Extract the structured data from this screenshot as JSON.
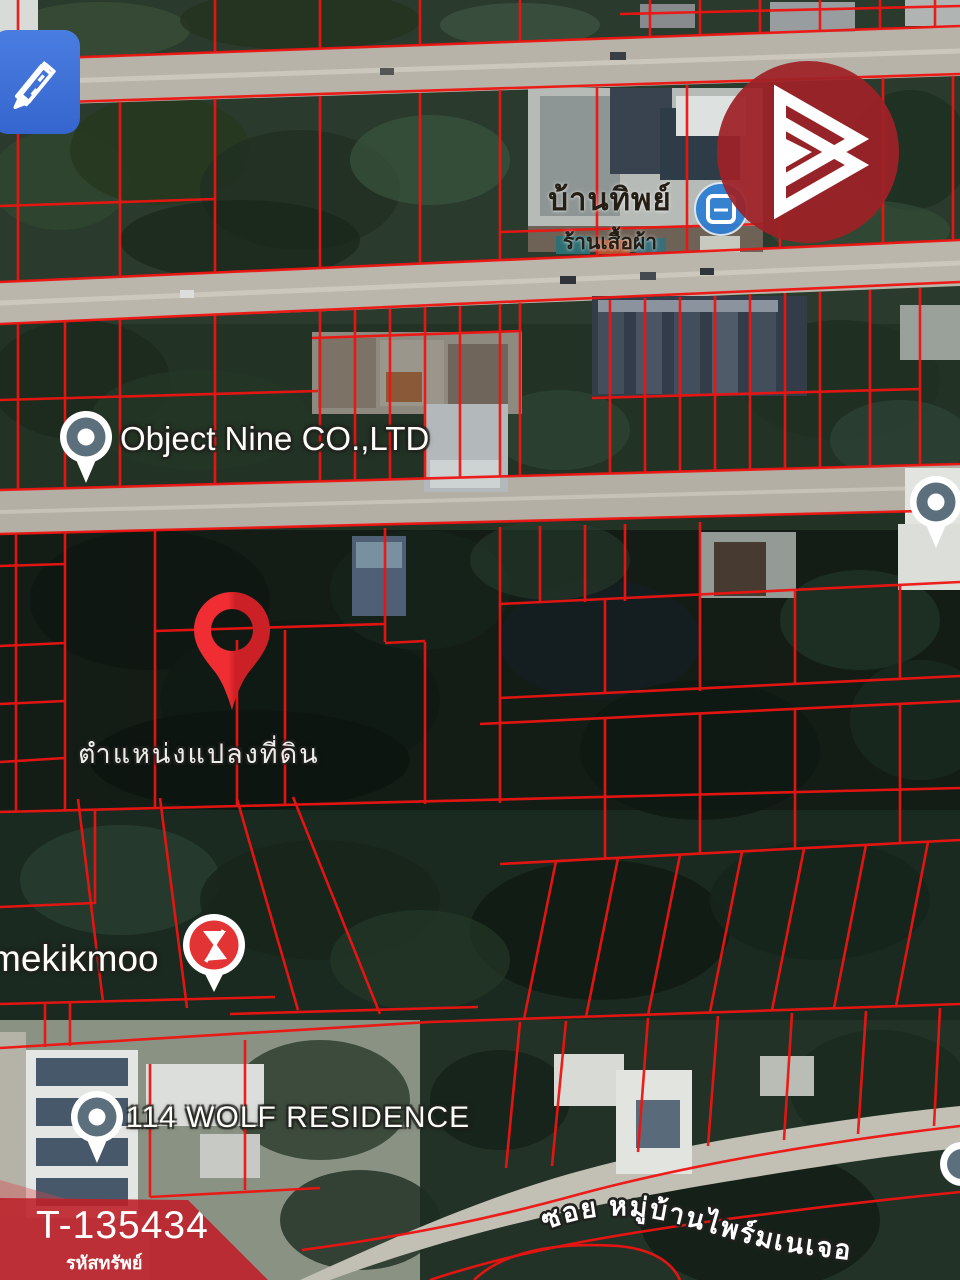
{
  "labels": {
    "shop": {
      "name": "บ้านทิพย์",
      "subtitle": "ร้านเสื้อผ้า"
    },
    "company": "Object Nine CO.,LTD",
    "plot_caption": "ตำแหน่งแปลงที่ดิน",
    "mekikmoo": "mekikmoo",
    "residence": "114 WOLF RESIDENCE",
    "road": "ซอย หมู่บ้านไพร์มเนเจอ"
  },
  "badge": {
    "code": "T-135434",
    "label": "รหัสทรัพย์"
  },
  "icons": {
    "edit_button": "pencil-ruler-icon",
    "brand_logo": "triangle-b-logo",
    "location_pin": "red-location-pin",
    "company_pin": "grey-poi-pin",
    "residence_pin": "grey-poi-pin",
    "right_edge_pin": "grey-poi-pin",
    "mekikmoo_pin": "red-poi-pin",
    "store": "storefront-icon"
  },
  "colors": {
    "parcel_line": "#ee1411",
    "badge_red": "#be212a",
    "brand_red": "#9e2127",
    "pin_red": "#e8252b",
    "edit_button_blue": "#3d70d8",
    "store_blue": "#2e7fd2",
    "poi_grey": "#5b707c",
    "road_grey": "#b7b3a8",
    "vegetation_dark": "#1b2920"
  }
}
